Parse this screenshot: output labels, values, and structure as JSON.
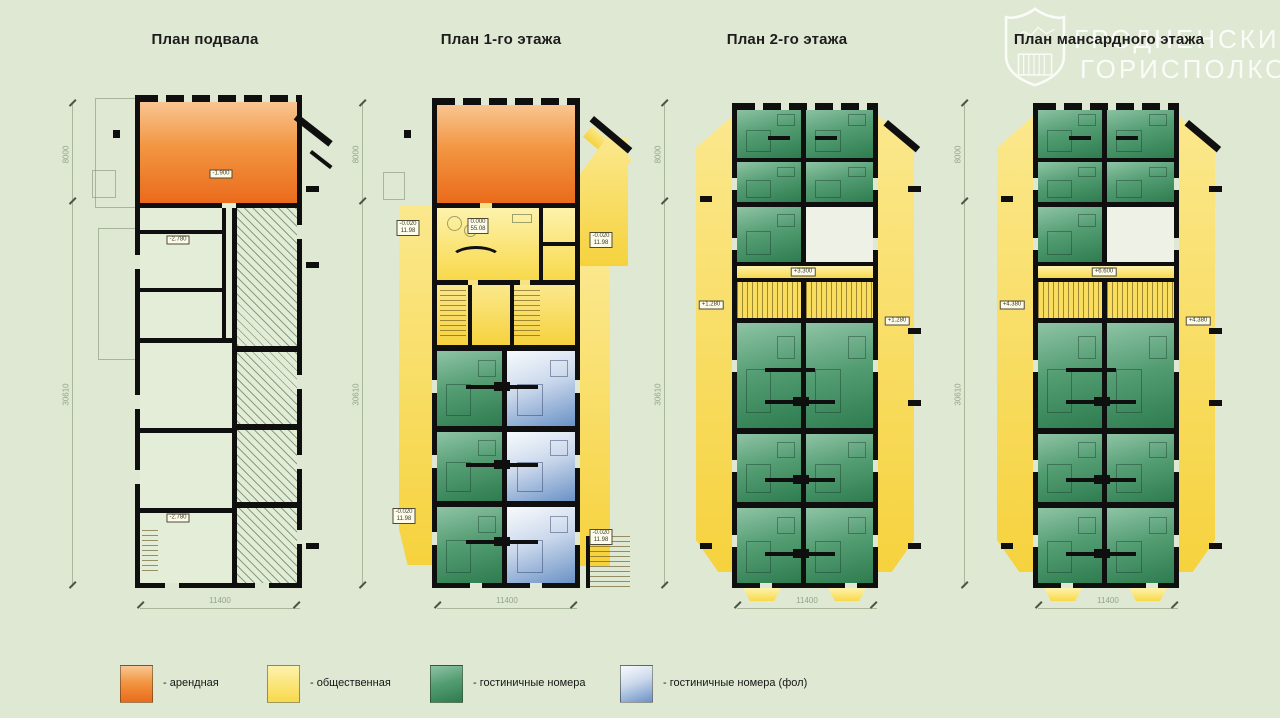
{
  "titles": [
    "План подвала",
    "План 1-го этажа",
    "План 2-го этажа",
    "План мансардного этажа"
  ],
  "dims": {
    "top": "8000",
    "side": "30610",
    "width": "11400"
  },
  "watermark": {
    "line1": "ГРОДНЕНСКИЙ",
    "line2": "ГОРИСПОЛКОМ"
  },
  "legend": [
    {
      "label": "- арендная",
      "color": "#ED6F1F"
    },
    {
      "label": "- общественная",
      "color": "#F8D840"
    },
    {
      "label": "- гостиничные номера",
      "color": "#3F8560"
    },
    {
      "label": "- гостиничные номера (фол)",
      "color": "#5D89C4"
    }
  ],
  "chips": {
    "basement": {
      "hall": "-1.900",
      "mid": "-2.780",
      "low": "-2.780"
    },
    "floor1": {
      "center_l1": "0.000",
      "center_l2": "55.08",
      "left_l1": "-0.020",
      "left_l2": "11.98",
      "right_l1": "-0.020",
      "right_l2": "11.98",
      "lowleft_l1": "-0.020",
      "lowleft_l2": "11.98",
      "lowright_l1": "-0.020",
      "lowright_l2": "11.98"
    },
    "floor2": {
      "center": "+3.300",
      "left": "+1.280",
      "right": "+1.280"
    },
    "attic": {
      "center": "+6.600",
      "left": "+4.380",
      "right": "+4.380"
    }
  }
}
